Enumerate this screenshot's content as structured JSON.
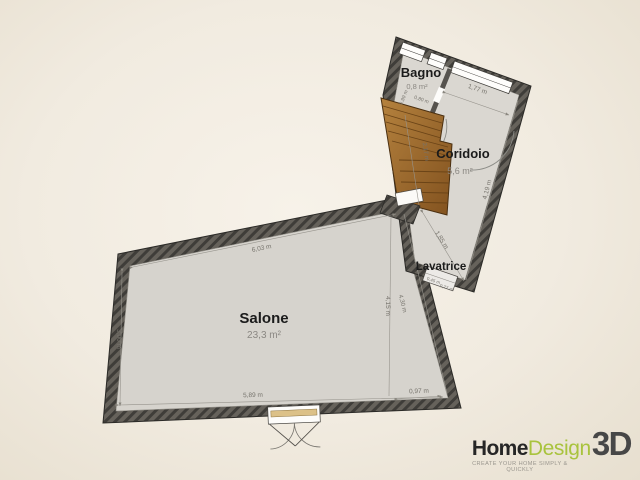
{
  "plan": {
    "rooms": {
      "salone": {
        "name": "Salone",
        "area": "23,3 m²"
      },
      "coridoio": {
        "name": "Coridoio",
        "area": "5,6 m²"
      },
      "bagno": {
        "name": "Bagno",
        "area": "0,8 m²"
      },
      "lavatrice": {
        "name": "Lavatrice"
      }
    },
    "dimensions": {
      "salone_top": "6,03 m",
      "salone_left": "3,00 m",
      "salone_bottom": "5,89 m",
      "salone_right": "4,15 m",
      "salone_right_wall": "4,30 m",
      "salone_bottom_right": "0,97 m",
      "coridoio_top": "1,77 m",
      "coridoio_right": "4,19 m",
      "coridoio_left": "2,17 m",
      "coridoio_to_lavatrice": "1,85 m",
      "bagno_width": "0,99 m",
      "bagno_depth": "0,80 m",
      "lavatrice_width": "0,45 m",
      "lavatrice_depth": "0,77 m"
    }
  },
  "logo": {
    "home": "Home",
    "design": "Design",
    "threed": "3D",
    "tagline": "CREATE YOUR HOME SIMPLY & QUICKLY",
    "accent_color": "#a9c33d"
  },
  "colors": {
    "background": "#f1ebe0",
    "wall": "#66625b",
    "wall_hatch": "#3f3d39",
    "floor": "#d6d3cd",
    "wood": "#9a6a2f",
    "dimension_text": "#76736c"
  }
}
